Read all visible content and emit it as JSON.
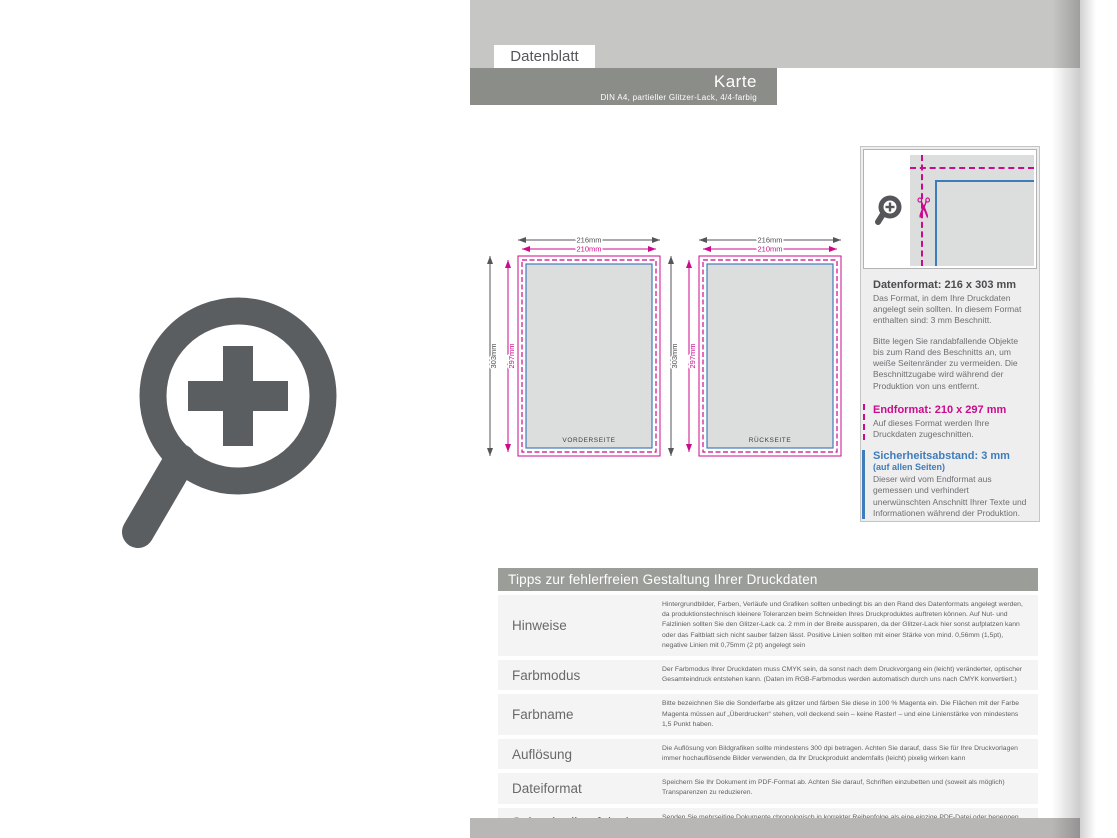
{
  "header": {
    "tab": "Datenblatt",
    "title": "Karte",
    "subtitle": "DIN A4, partieller Glitzer-Lack, 4/4-farbig"
  },
  "diagram": {
    "front_label": "VORDERSEITE",
    "back_label": "RÜCKSEITE",
    "dims": {
      "outer_width": "216mm",
      "inner_width": "210mm",
      "outer_height": "303mm",
      "inner_height": "297mm"
    }
  },
  "icons": {
    "scissors_glyph": "✂",
    "zoom_plus": "magnifier with plus sign"
  },
  "colors": {
    "magenta_cutline": "#cb0b8d",
    "blue_safety": "#3f7cba",
    "card_fill": "#dcdddd",
    "icon_gray": "#5b5e61",
    "band_dark": "#8b8d89",
    "band_light": "#c6c7c5"
  },
  "info_panel": {
    "datenformat_title": "Datenformat: 216 x 303 mm",
    "datenformat_text1": "Das Format, in dem Ihre Druckdaten angelegt sein sollten. In diesem Format enthalten sind: 3 mm Beschnitt.",
    "datenformat_text2": "Bitte legen Sie randabfallende Objekte bis zum Rand des Beschnitts an, um weiße Seitenränder zu vermeiden. Die Beschnittzugabe wird während der Produktion von uns entfernt.",
    "endformat_title": "Endformat: 210 x 297 mm",
    "endformat_text": "Auf dieses Format werden Ihre Druckdaten zugeschnitten.",
    "sicherheit_title": "Sicherheitsabstand: 3 mm",
    "sicherheit_subtitle": "(auf allen Seiten)",
    "sicherheit_text": "Dieser wird vom Endformat aus gemessen und verhindert unerwünschten Anschnitt Ihrer Texte und Informationen während der Produktion."
  },
  "tips": {
    "header": "Tipps zur fehlerfreien Gestaltung Ihrer Druckdaten",
    "rows": [
      {
        "label": "Hinweise",
        "text": "Hintergrundbilder, Farben, Verläufe und Grafiken sollten unbedingt bis an den Rand des Datenformats angelegt werden, da produktionstechnisch kleinere Toleranzen beim Schneiden Ihres Druckproduktes auftreten können. Auf Nut- und Falzlinien sollten Sie den Glitzer-Lack ca. 2 mm in der Breite aussparen, da der Glitzer-Lack hier sonst aufplatzen kann oder das Faltblatt sich nicht sauber falzen lässt. Positive Linien sollten mit einer Stärke von mind. 0,56mm (1,5pt), negative Linien mit 0,75mm (2 pt) angelegt sein"
      },
      {
        "label": "Farbmodus",
        "text": "Der Farbmodus Ihrer Druckdaten muss CMYK sein, da sonst nach dem Druckvorgang ein (leicht) veränderter, optischer Gesamteindruck entstehen kann. (Daten im RGB-Farbmodus werden automatisch durch uns nach CMYK konvertiert.)"
      },
      {
        "label": "Farbname",
        "text": "Bitte bezeichnen Sie die Sonderfarbe als glitzer und färben Sie diese in 100 % Magenta ein. Die Flächen mit der Farbe Magenta müssen auf „Überdrucken“ stehen, voll deckend sein – keine Raster! – und eine Linienstärke von mindestens 1,5 Punkt haben."
      },
      {
        "label": "Auflösung",
        "text": "Die Auflösung von Bildgrafiken sollte mindestens 300 dpi betragen. Achten Sie darauf, dass Sie für Ihre Druckvorlagen immer hochauflösende Bilder verwenden, da Ihr Druckprodukt andernfalls (leicht) pixelig wirken kann"
      },
      {
        "label": "Dateiformat",
        "text": "Speichern Sie Ihr Dokument im PDF-Format ab. Achten Sie darauf, Schriften einzubetten und (soweit als möglich) Transparenzen zu reduzieren."
      },
      {
        "label": "Seiten(-reihenfolge)",
        "text": "Senden Sie mehrseitige Dokumente chronologisch in korrekter Reihenfolge als eine einzige PDF-Datei oder benennen Sie Einzeldokumente entsprechend mit fortlaufenden Seitennummern."
      }
    ]
  }
}
